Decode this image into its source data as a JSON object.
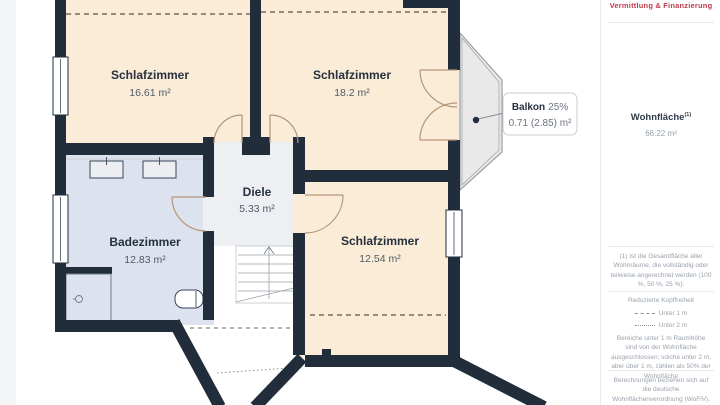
{
  "plan": {
    "rooms": [
      {
        "name": "Schlafzimmer",
        "area": "16.61 m²"
      },
      {
        "name": "Schlafzimmer",
        "area": "18.2 m²"
      },
      {
        "name": "Diele",
        "area": "5.33 m²"
      },
      {
        "name": "Badezimmer",
        "area": "12.83 m²"
      },
      {
        "name": "Schlafzimmer",
        "area": "12.54 m²"
      }
    ],
    "balkon": {
      "name": "Balkon",
      "percent": "25%",
      "area": "0.71 (2.85) m²"
    },
    "colors": {
      "wall": "#212d3b",
      "room": "#fbecd8",
      "bath": "#dce2ee",
      "hall": "#edeff2",
      "balcony": "#e9e9e9",
      "accent_red": "#bf3b4b"
    }
  },
  "sidebar": {
    "logo_text": "Vermittlung & Finanzierung",
    "wohnflaeche_label": "Wohnfläche",
    "wohnflaeche_sup": "(1)",
    "wohnflaeche_value": "66.22 m²",
    "footnote": "(1) Ist die Gesamtfläche aller Wohnräume, die vollständig oder teilweise angerechnet werden (100 %, 50 %, 25 %).",
    "legend": {
      "title": "Reduzierte Kopffreiheit",
      "items": [
        {
          "style": "dashed",
          "label": "Unter 1 m"
        },
        {
          "style": "dotted",
          "label": "Unter 2 m"
        }
      ],
      "note": "Bereiche unter 1 m Raumhöhe sind von der Wohnfläche ausgeschlossen; solche unter 2 m, aber über 1 m, zählen als 50% der Wohnfläche"
    },
    "disclaimer": "Berechnungen beziehen sich auf die deutsche Wohnflächenverordnung (WoFlV). Maße sind ungefähre Angaben"
  }
}
